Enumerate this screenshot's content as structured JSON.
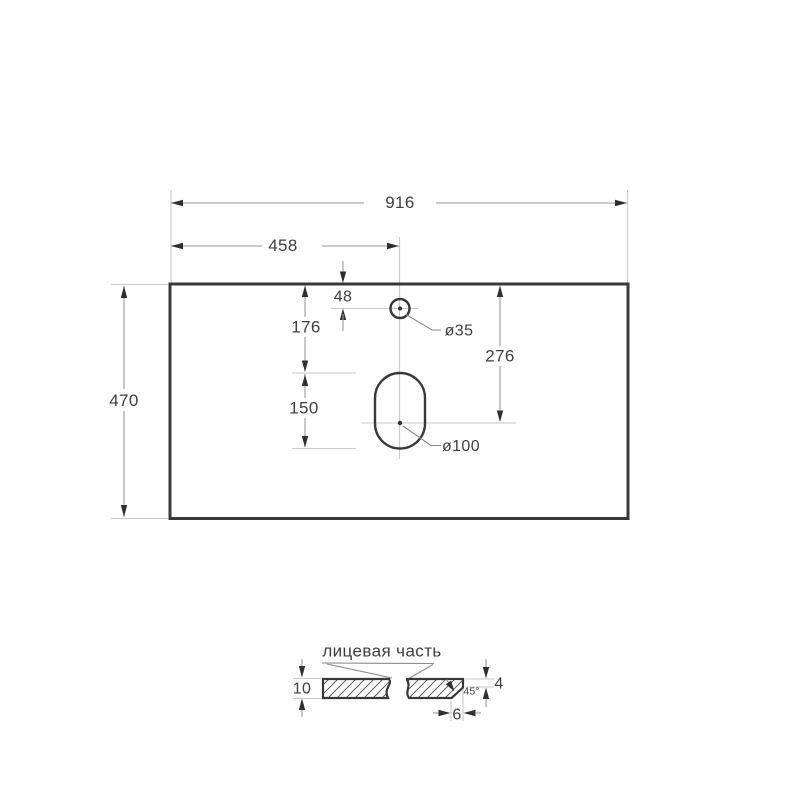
{
  "drawing": {
    "kind": "countertop-dimension-drawing",
    "plan_view": {
      "overall_width": "916",
      "center_offset": "458",
      "depth": "470",
      "faucet_offset_from_edge": "48",
      "faucet_zone_top": "176",
      "drain_slot_height": "150",
      "drain_center_from_edge": "276",
      "faucet_hole_diameter": "ø35",
      "drain_hole_diameter": "ø100"
    },
    "section_view": {
      "label": "лицевая часть",
      "thickness": "10",
      "front_edge_height": "4",
      "chamfer_depth": "6",
      "chamfer_angle": "45°"
    },
    "colors": {
      "background": "#ffffff",
      "outline": "#383838",
      "dimension_line": "#9a9a9a",
      "extension_line": "#c9c9c9",
      "arrow": "#2f2f2f",
      "text": "#3e3e3e",
      "hatch": "#606060"
    }
  }
}
